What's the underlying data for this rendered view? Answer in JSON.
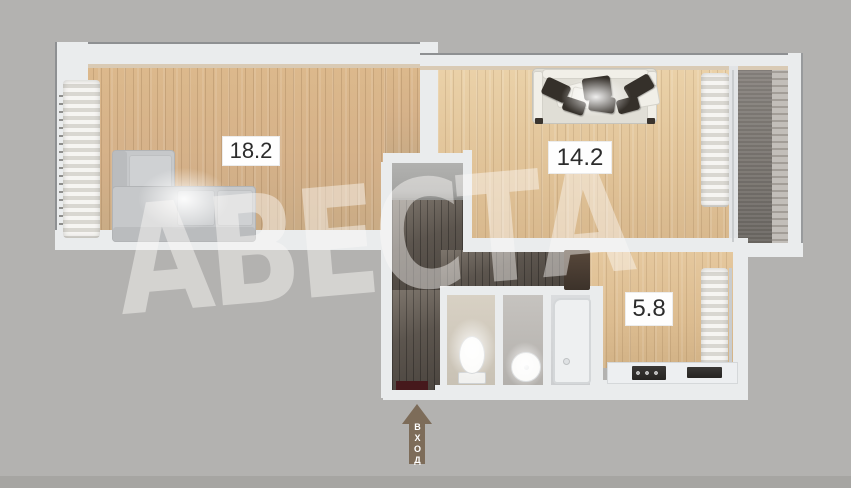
{
  "watermark": "АВЕСТА",
  "entrance": {
    "label": "ВХОД"
  },
  "rooms": [
    {
      "key": "living-room",
      "area": "18.2"
    },
    {
      "key": "hall-room",
      "area": "14.2"
    },
    {
      "key": "kitchen",
      "area": "5.8"
    }
  ],
  "colors": {
    "background": "#b3b2b0",
    "wall": "#eaeced",
    "wood_floor": "#d9b78c",
    "corridor_floor": "#57504a",
    "balcony_floor": "#7c7873",
    "entrance_arrow": "#7d6c59",
    "entrance_door": "#46191c",
    "label_text": "#2c2c2c"
  }
}
